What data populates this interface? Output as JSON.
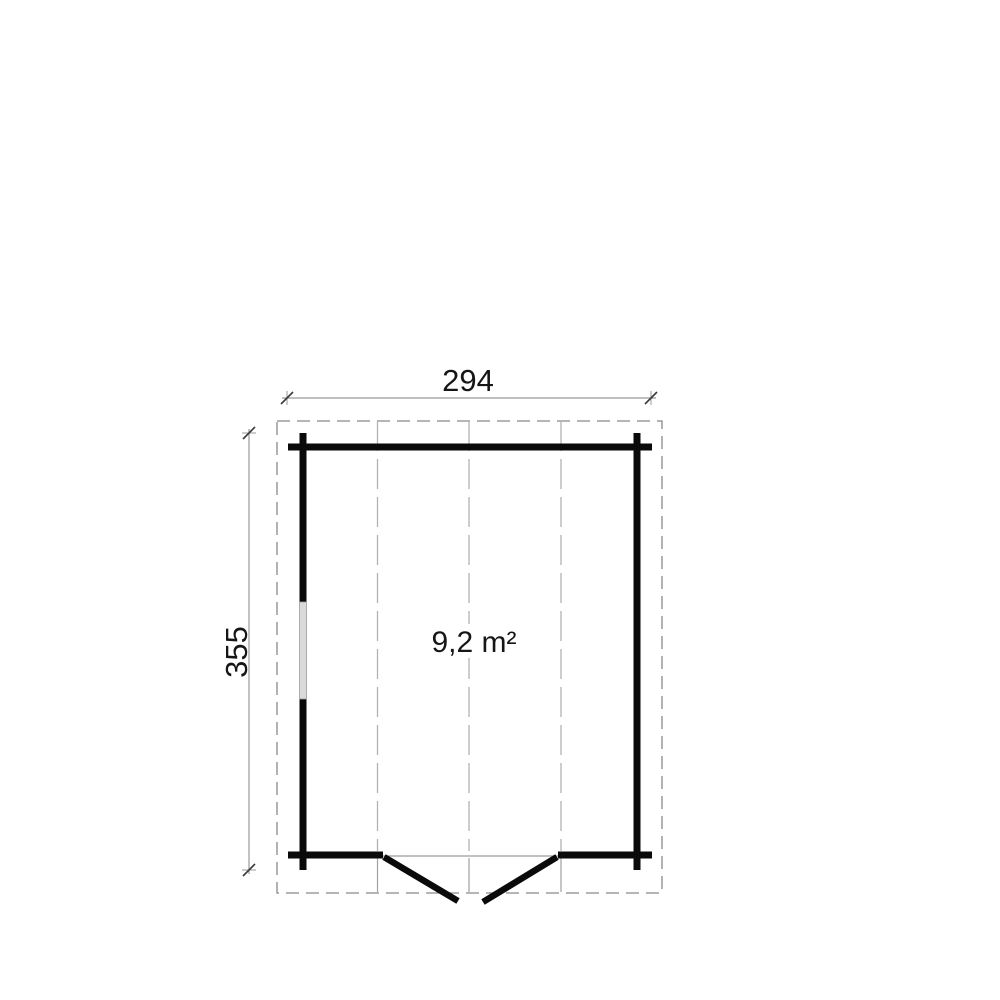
{
  "floor_plan": {
    "title": "log-cabin floor plan",
    "dimensions": {
      "width_label": "294",
      "height_label": "355"
    },
    "room": {
      "area_label": "9,2 m²"
    },
    "features": {
      "door": "double door, bottom wall, opening outward",
      "window": "single window, left wall",
      "roof_overhang": "dashed outline",
      "roof_panel_lines": 3
    },
    "colors": {
      "wall": "#0a0a0a",
      "overhang_dash": "#898989",
      "panel_dash": "#b2b2b2",
      "dimension_line": "#999999",
      "dimension_tick": "#3a3a3a",
      "dimension_text": "#161616",
      "window_fill": "#dadada",
      "background": "#ffffff"
    }
  }
}
